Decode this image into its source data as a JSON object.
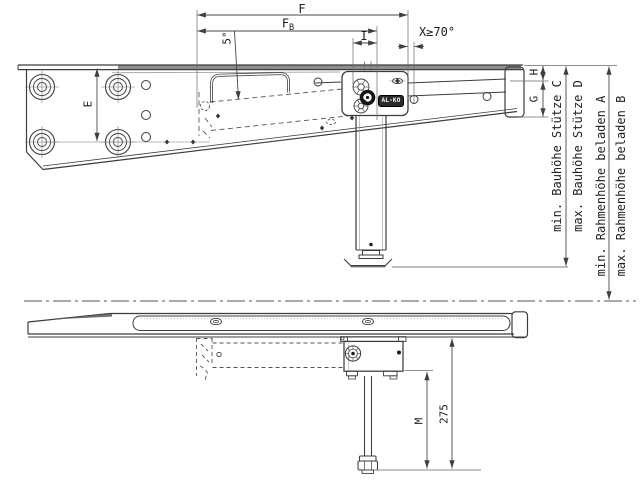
{
  "drawing": {
    "brand_badge": "AL-KO",
    "top_view": {
      "dim_f": "F",
      "dim_fb": {
        "main": "F",
        "sub": "B"
      },
      "dim_i": "I",
      "dim_x": "X≥70°",
      "dim_angle": "5°",
      "dim_e": "E",
      "dim_h": "H",
      "dim_g": "G"
    },
    "height_dims": {
      "c": "min. Bauhöhe Stütze C",
      "d": "max. Bauhöhe Stütze D",
      "a": "min. Rahmenhöhe beladen A",
      "b": "max. Rahmenhöhe beladen B"
    },
    "bottom_view": {
      "dim_m": "M",
      "dim_275": "275"
    },
    "colors": {
      "line": "#3c3c3c",
      "dim_line": "#474747",
      "ext_line": "#6a6a6a",
      "flange_fill": "#8e8e8e",
      "badge_bg": "#2a2a2a",
      "badge_text": "#ffffff",
      "background": "#ffffff"
    }
  }
}
